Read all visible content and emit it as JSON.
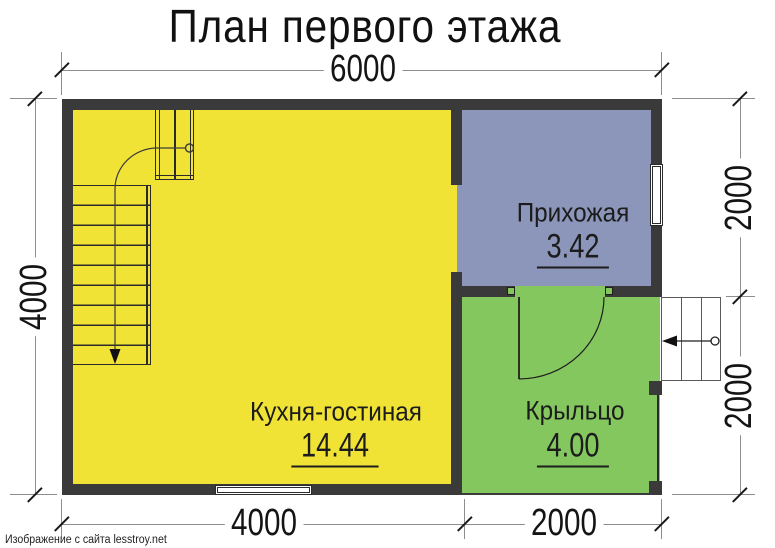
{
  "title": "План первого этажа",
  "watermark": "Изображение с сайта lesstroy.net",
  "dimensions": {
    "top": "6000",
    "left": "4000",
    "right_upper": "2000",
    "right_lower": "2000",
    "bottom_left": "4000",
    "bottom_right": "2000"
  },
  "rooms": [
    {
      "name": "Кухня-гостиная",
      "area": "14.44",
      "color": "#f0e335"
    },
    {
      "name": "Прихожая",
      "area": "3.42",
      "color": "#8b96ba"
    },
    {
      "name": "Крыльцо",
      "area": "4.00",
      "color": "#85c75f"
    }
  ],
  "colors": {
    "wall": "#3a3a3a",
    "dim_line": "#8d8d8d",
    "text": "#1c1c1c"
  }
}
